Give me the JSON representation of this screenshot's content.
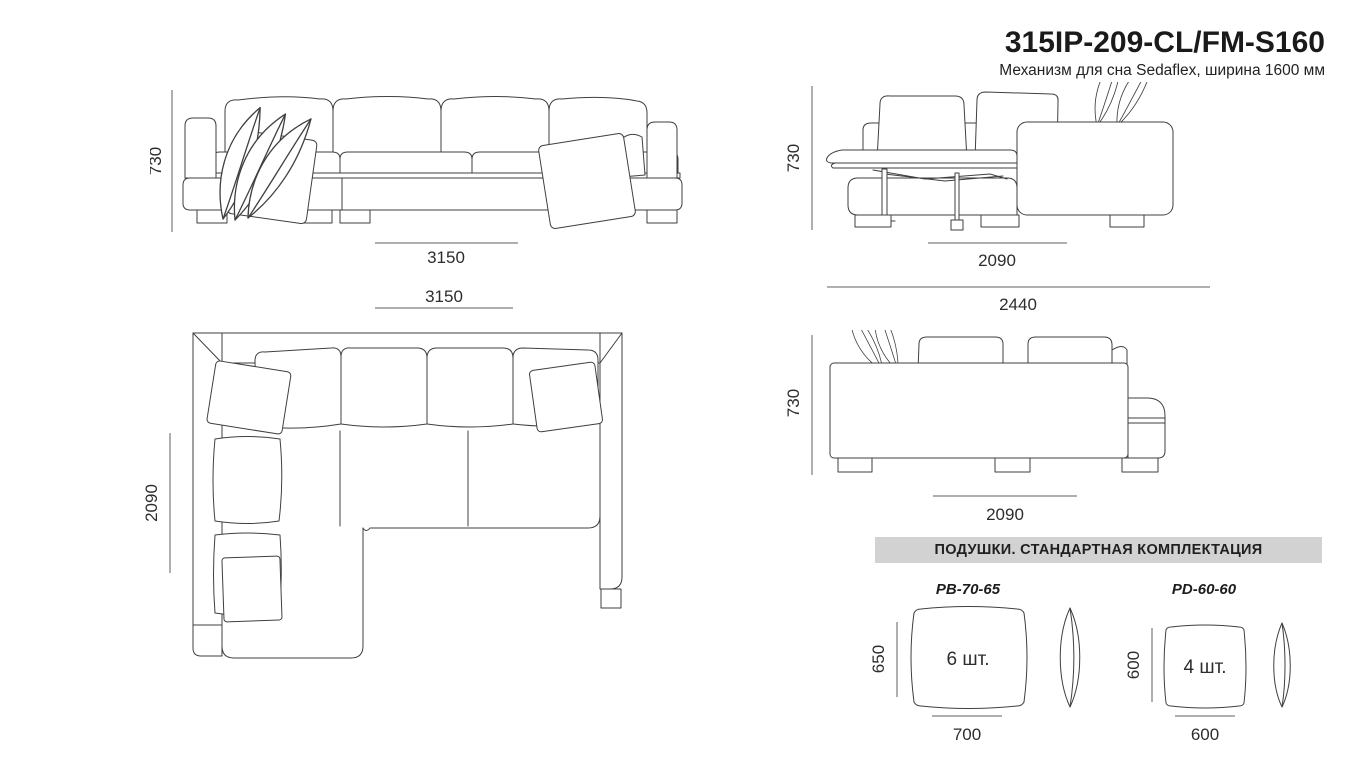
{
  "header": {
    "title": "315IP-209-CL/FM-S160",
    "subtitle": "Механизм для сна Sedaflex, ширина 1600 мм"
  },
  "views": {
    "front": {
      "height": "730",
      "width": "3150"
    },
    "plan": {
      "width": "3150",
      "depth": "2090"
    },
    "unfolded": {
      "height": "730",
      "bed_width": "2090",
      "total_width": "2440"
    },
    "back": {
      "height": "730",
      "width": "2090"
    }
  },
  "pillows": {
    "header": "ПОДУШКИ. СТАНДАРТНАЯ КОМПЛЕКТАЦИЯ",
    "items": [
      {
        "name": "PB-70-65",
        "height": "650",
        "width": "700",
        "qty": "6 шт."
      },
      {
        "name": "PD-60-60",
        "height": "600",
        "width": "600",
        "qty": "4 шт."
      }
    ]
  },
  "colors": {
    "line": "#3f3f3f",
    "dimension": "#5f5f5f",
    "text": "#1a1a1a",
    "band": "#d2d2d2",
    "background": "#ffffff"
  }
}
